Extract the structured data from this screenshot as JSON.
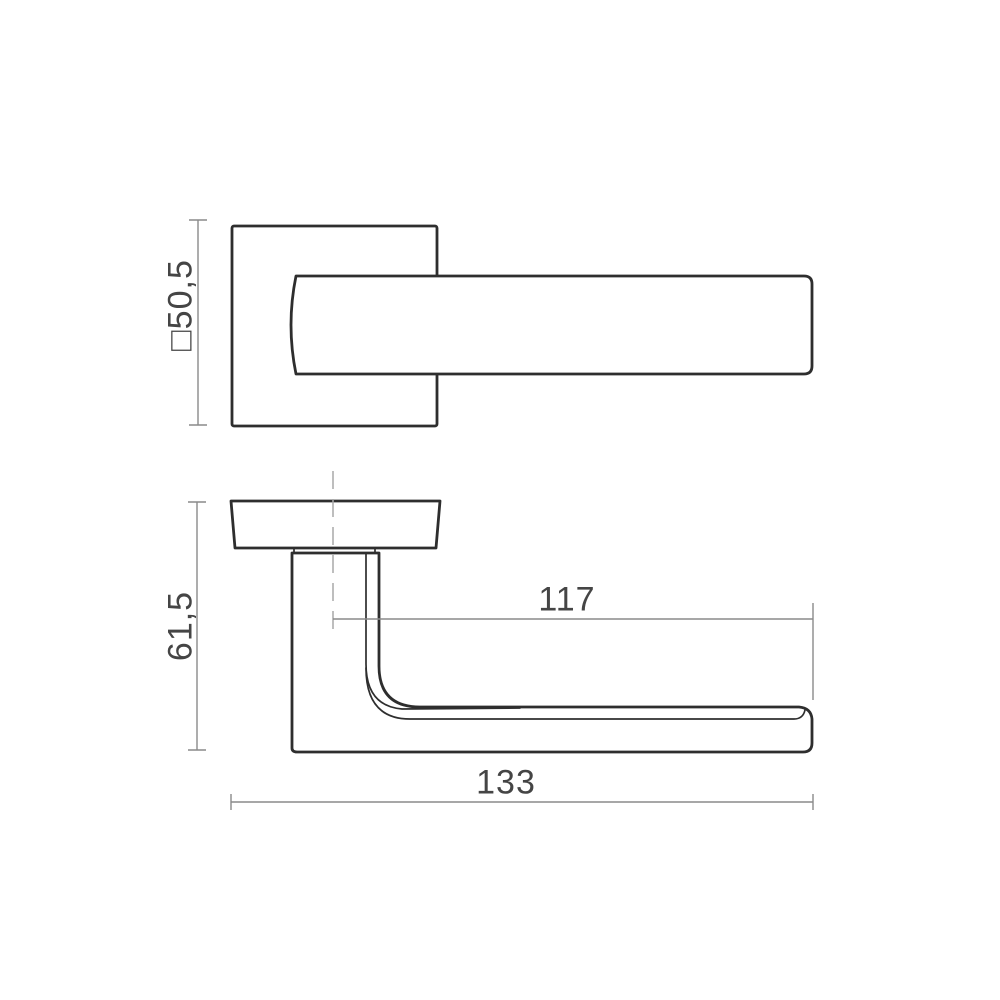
{
  "labels": {
    "rose_square": "□50,5",
    "height": "61,5",
    "reach": "117",
    "length": "133"
  },
  "colors": {
    "outline": "#2e2e2e",
    "dimension": "#8a8a8a",
    "centerline": "#a8a8a8",
    "label": "#454545",
    "background": "#ffffff"
  }
}
